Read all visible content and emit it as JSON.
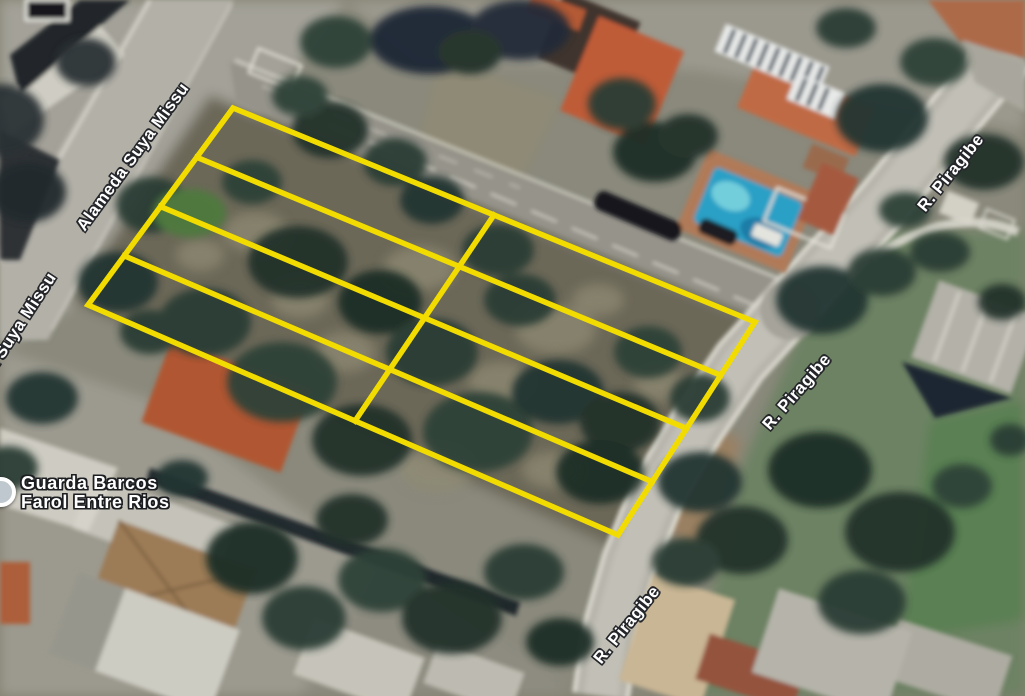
{
  "map": {
    "view_type": "satellite",
    "streets": {
      "alameda": "Alameda Suya Missu",
      "piragibe": "R. Piragibe"
    },
    "poi": {
      "name_line1": "Guarda Barcos",
      "name_line2": "Farol Entre Rios"
    },
    "lot_overlay": {
      "outline_color": "#f2dc00",
      "rows": 4,
      "columns": 2,
      "lot_count": 8
    },
    "label_style": {
      "text_color": "#ffffff",
      "outline_color": "#24262a"
    }
  }
}
